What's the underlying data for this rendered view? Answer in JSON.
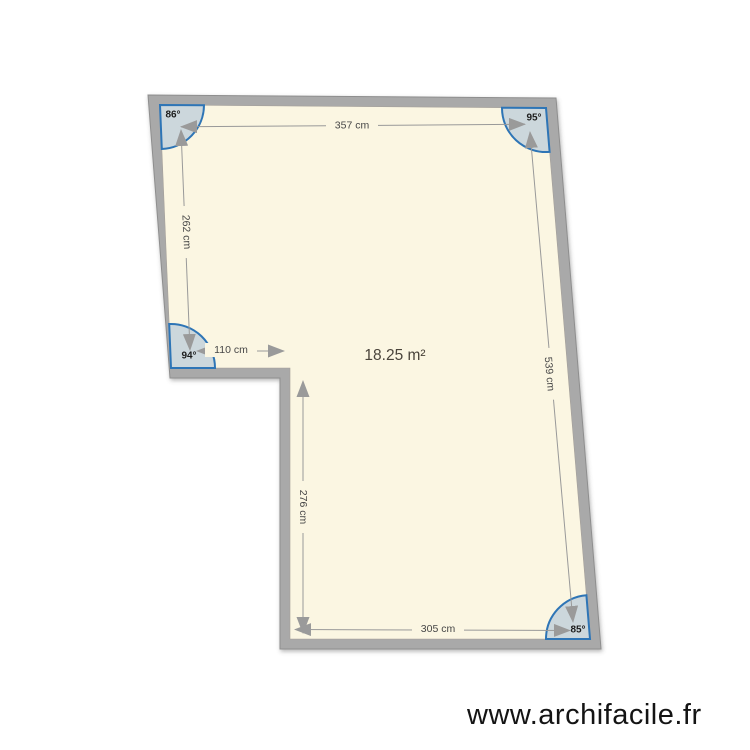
{
  "watermark": "www.archifacile.fr",
  "plan": {
    "area_label": "18.25 m²",
    "dimensions": [
      {
        "name": "top-wall",
        "label": "357 cm"
      },
      {
        "name": "left-wall",
        "label": "262 cm"
      },
      {
        "name": "right-wall",
        "label": "539 cm"
      },
      {
        "name": "notch-wall",
        "label": "110 cm"
      },
      {
        "name": "inner-wall",
        "label": "276 cm"
      },
      {
        "name": "bottom-wall",
        "label": "305 cm"
      }
    ],
    "angles": [
      {
        "name": "top-left",
        "label": "86°"
      },
      {
        "name": "top-right",
        "label": "95°"
      },
      {
        "name": "mid-left",
        "label": "94°"
      },
      {
        "name": "bottom-right",
        "label": "85°"
      }
    ],
    "colors": {
      "wall": "#a9a9a9",
      "wall_edge": "#8e8e8e",
      "floor": "#fbf6e2",
      "dimension_line": "#999999",
      "arrow": "#9a9a9a",
      "angle_marker_stroke": "#2e75b6",
      "angle_marker_fill": "#9db8d6"
    }
  }
}
